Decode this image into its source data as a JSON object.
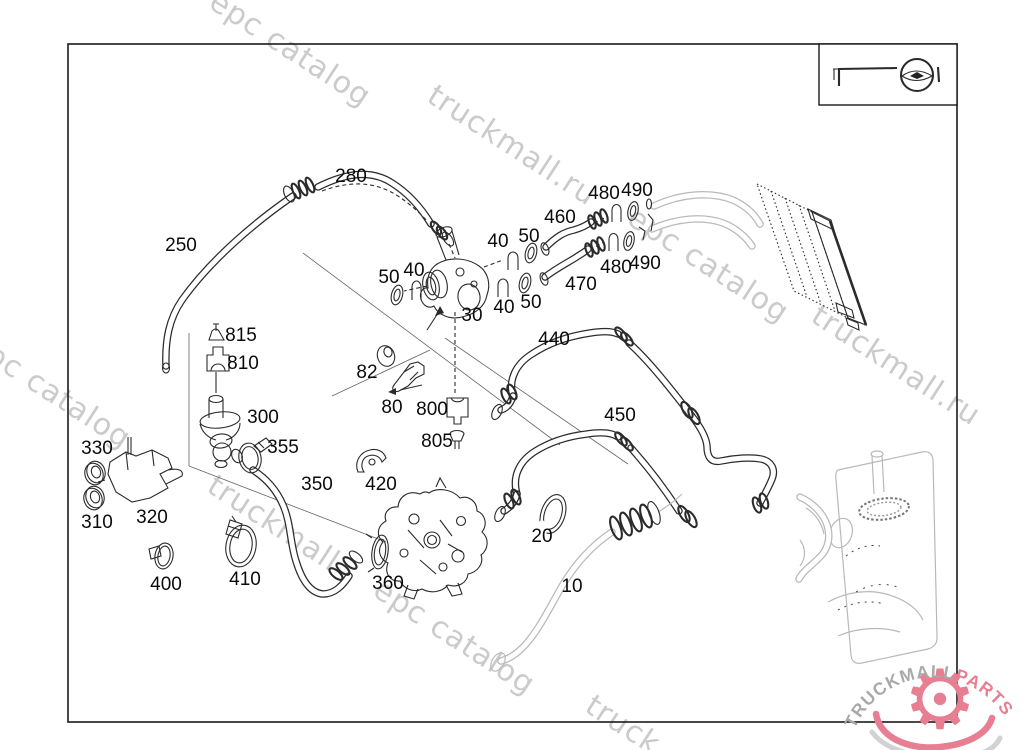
{
  "page": {
    "background": "#ffffff",
    "frame_color": "#1a1a1a"
  },
  "watermark": {
    "text": "truckmall.ru epc catalog",
    "color": "#cbcbcb",
    "strips": [
      "epc catalog",
      "truckmall.ru",
      "epc catalog",
      "truckmall.ru",
      "epc catalog",
      "truckmall",
      "epc catalog",
      "truck"
    ]
  },
  "legend_box": {
    "icon": "pipe-connector-symbol-icon"
  },
  "part_labels": [
    {
      "text": "280",
      "x": 351,
      "y": 182
    },
    {
      "text": "250",
      "x": 181,
      "y": 251
    },
    {
      "text": "50",
      "x": 389,
      "y": 283
    },
    {
      "text": "40",
      "x": 414,
      "y": 276
    },
    {
      "text": "30",
      "x": 472,
      "y": 321
    },
    {
      "text": "40",
      "x": 498,
      "y": 247
    },
    {
      "text": "50",
      "x": 529,
      "y": 242
    },
    {
      "text": "40",
      "x": 504,
      "y": 313
    },
    {
      "text": "50",
      "x": 531,
      "y": 308
    },
    {
      "text": "460",
      "x": 560,
      "y": 223
    },
    {
      "text": "470",
      "x": 581,
      "y": 290
    },
    {
      "text": "480",
      "x": 604,
      "y": 199
    },
    {
      "text": "490",
      "x": 637,
      "y": 196
    },
    {
      "text": "480",
      "x": 616,
      "y": 273
    },
    {
      "text": "490",
      "x": 645,
      "y": 269
    },
    {
      "text": "440",
      "x": 554,
      "y": 345
    },
    {
      "text": "450",
      "x": 620,
      "y": 421
    },
    {
      "text": "815",
      "x": 241,
      "y": 341
    },
    {
      "text": "810",
      "x": 243,
      "y": 369
    },
    {
      "text": "300",
      "x": 263,
      "y": 423
    },
    {
      "text": "355",
      "x": 283,
      "y": 453
    },
    {
      "text": "330",
      "x": 97,
      "y": 454
    },
    {
      "text": "310",
      "x": 97,
      "y": 528
    },
    {
      "text": "320",
      "x": 152,
      "y": 523
    },
    {
      "text": "82",
      "x": 367,
      "y": 378
    },
    {
      "text": "80",
      "x": 392,
      "y": 413
    },
    {
      "text": "800",
      "x": 432,
      "y": 415
    },
    {
      "text": "805",
      "x": 437,
      "y": 447
    },
    {
      "text": "350",
      "x": 317,
      "y": 490
    },
    {
      "text": "420",
      "x": 381,
      "y": 490
    },
    {
      "text": "400",
      "x": 166,
      "y": 590
    },
    {
      "text": "410",
      "x": 245,
      "y": 585
    },
    {
      "text": "360",
      "x": 388,
      "y": 589
    },
    {
      "text": "20",
      "x": 542,
      "y": 542
    },
    {
      "text": "10",
      "x": 572,
      "y": 592
    }
  ],
  "logo": {
    "brand_gray": "TRUCKMALL",
    "brand_pink": "PARTS",
    "gear_glyph": "⚙",
    "pink": "#e87e92",
    "gray": "#a9a9a9",
    "icon": "gear-icon"
  }
}
